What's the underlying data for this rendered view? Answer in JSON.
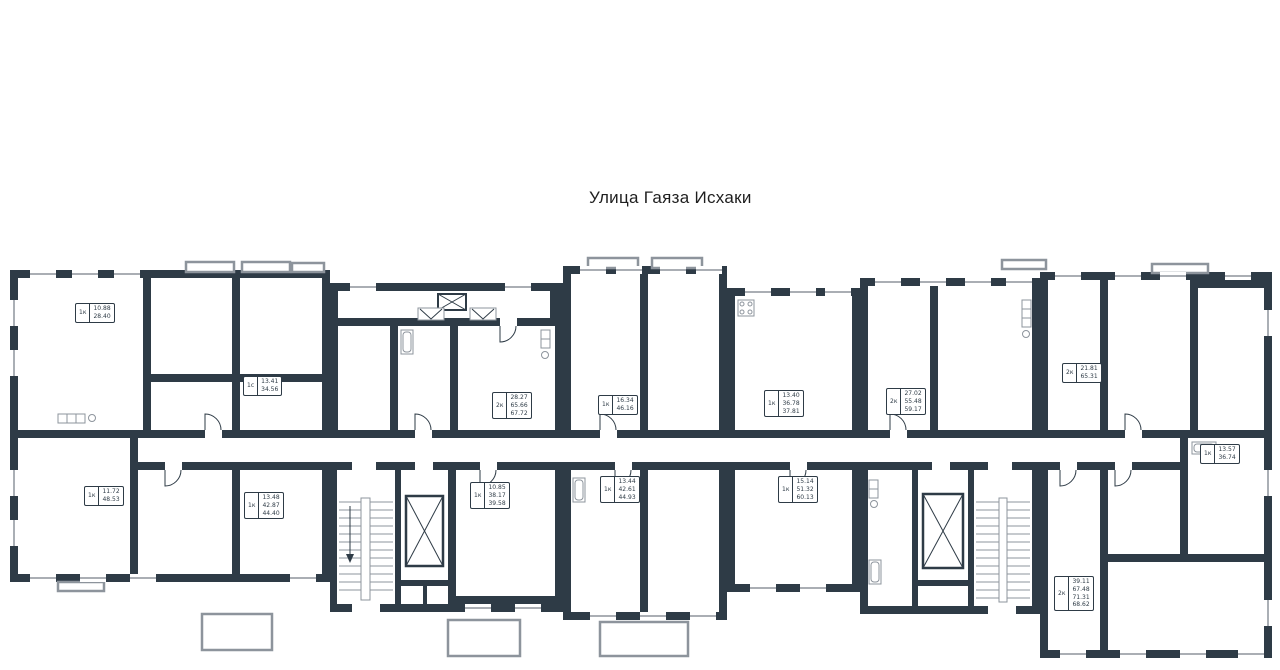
{
  "title": "Улица Гаяза Исхаки",
  "colors": {
    "wall": "#2e3b46",
    "thin_line": "#8d949c",
    "background": "#ffffff"
  },
  "legend": {
    "apartment_type_labels": [
      "1к",
      "1с",
      "2к"
    ],
    "icon_names": [
      "stairs-icon",
      "elevator-icon",
      "vent-shaft-icon",
      "bathtub-icon",
      "kitchen-counter-icon",
      "sink-icon",
      "stove-icon"
    ]
  },
  "apartments": [
    {
      "type": "1к",
      "areas": [
        "10.88",
        "28.40"
      ],
      "x": 75,
      "y": 303
    },
    {
      "type": "1с",
      "areas": [
        "13.41",
        "34.56"
      ],
      "x": 243,
      "y": 376
    },
    {
      "type": "2к",
      "areas": [
        "28.27",
        "65.66",
        "67.72"
      ],
      "x": 492,
      "y": 392
    },
    {
      "type": "1к",
      "areas": [
        "16.34",
        "46.16"
      ],
      "x": 598,
      "y": 395
    },
    {
      "type": "1к",
      "areas": [
        "13.40",
        "36.78",
        "37.81"
      ],
      "x": 764,
      "y": 390
    },
    {
      "type": "2к",
      "areas": [
        "27.02",
        "55.48",
        "59.17"
      ],
      "x": 886,
      "y": 388
    },
    {
      "type": "2к",
      "areas": [
        "21.81",
        "65.31"
      ],
      "x": 1062,
      "y": 363
    },
    {
      "type": "1к",
      "areas": [
        "13.57",
        "36.74"
      ],
      "x": 1200,
      "y": 444
    },
    {
      "type": "1к",
      "areas": [
        "11.72",
        "48.53"
      ],
      "x": 84,
      "y": 486
    },
    {
      "type": "1к",
      "areas": [
        "13.48",
        "42.87",
        "44.40"
      ],
      "x": 244,
      "y": 492
    },
    {
      "type": "1к",
      "areas": [
        "10.85",
        "38.17",
        "39.58"
      ],
      "x": 470,
      "y": 482
    },
    {
      "type": "1к",
      "areas": [
        "13.44",
        "42.61",
        "44.93"
      ],
      "x": 600,
      "y": 476
    },
    {
      "type": "1к",
      "areas": [
        "15.14",
        "51.32",
        "60.13"
      ],
      "x": 778,
      "y": 476
    },
    {
      "type": "2к",
      "areas": [
        "39.11",
        "67.48",
        "71.31",
        "68.62"
      ],
      "x": 1054,
      "y": 576
    }
  ]
}
